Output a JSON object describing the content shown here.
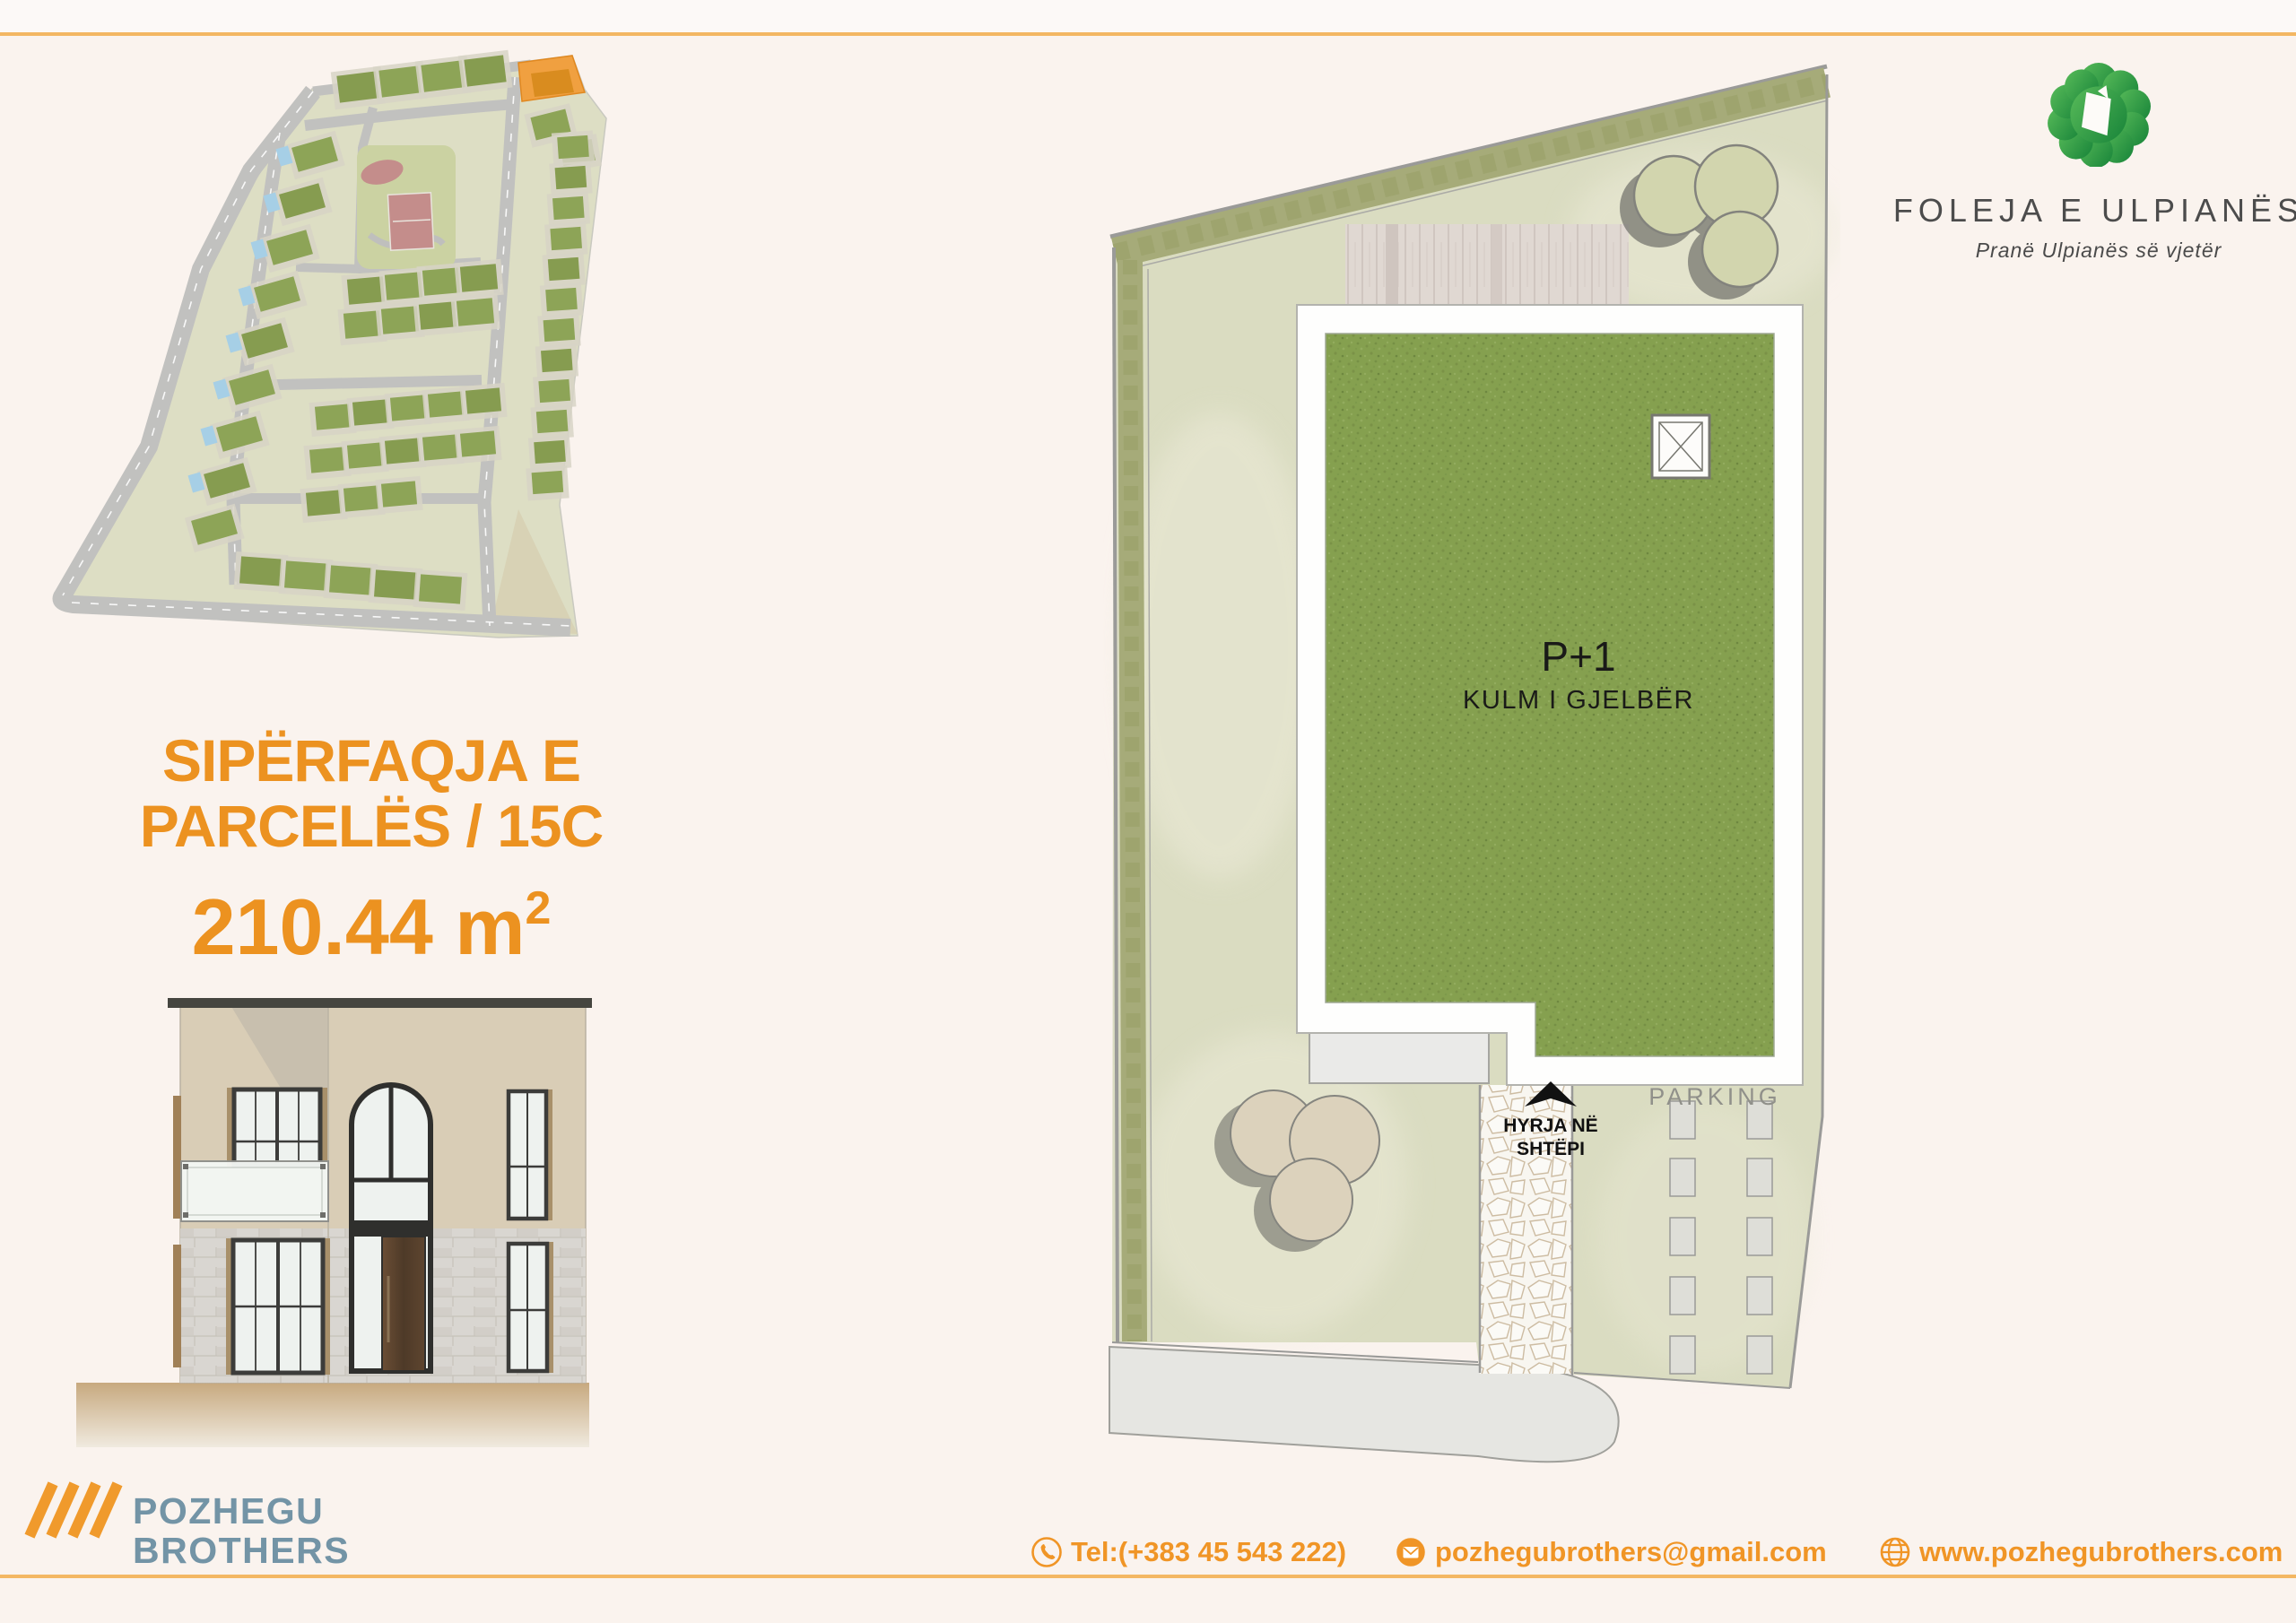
{
  "page": {
    "background": "#FAF3EE",
    "accent_orange": "#EC9220",
    "line_orange": "#F3B763"
  },
  "brand": {
    "name": "FOLEJA E ULPIANËS",
    "tagline": "Pranë Ulpianës së vjetër",
    "logo_green_light": "#55B857",
    "logo_green_dark": "#1F8A3D"
  },
  "parcel": {
    "title_line1": "SIPËRFAQJA E",
    "title_line2": "PARCELËS / 15C",
    "area_value": "210.44 m",
    "area_superscript": "2",
    "highlight_color": "#F0A040"
  },
  "site_plan": {
    "floors_label": "P+1",
    "roof_label": "KULM I GJELBËR",
    "parking_label": "PARKING",
    "entrance_line1": "HYRJA NË",
    "entrance_line2": "SHTËPI",
    "green_roof_color": "#85A04F",
    "lawn_color": "#DADCC1",
    "hedge_color": "#A6AB79"
  },
  "company": {
    "name_line1": "POZHEGU",
    "name_line2": "BROTHERS",
    "text_color": "#7394A6",
    "slash_color": "#F09A2C"
  },
  "contact": {
    "phone": "Tel:(+383 45 543 222)",
    "email": "pozhegubrothers@gmail.com",
    "website": "www.pozhegubrothers.com"
  },
  "icons": {
    "phone": "phone-icon",
    "email": "envelope-icon",
    "website": "globe-icon",
    "brand": "green-clover-parcel-icon"
  }
}
